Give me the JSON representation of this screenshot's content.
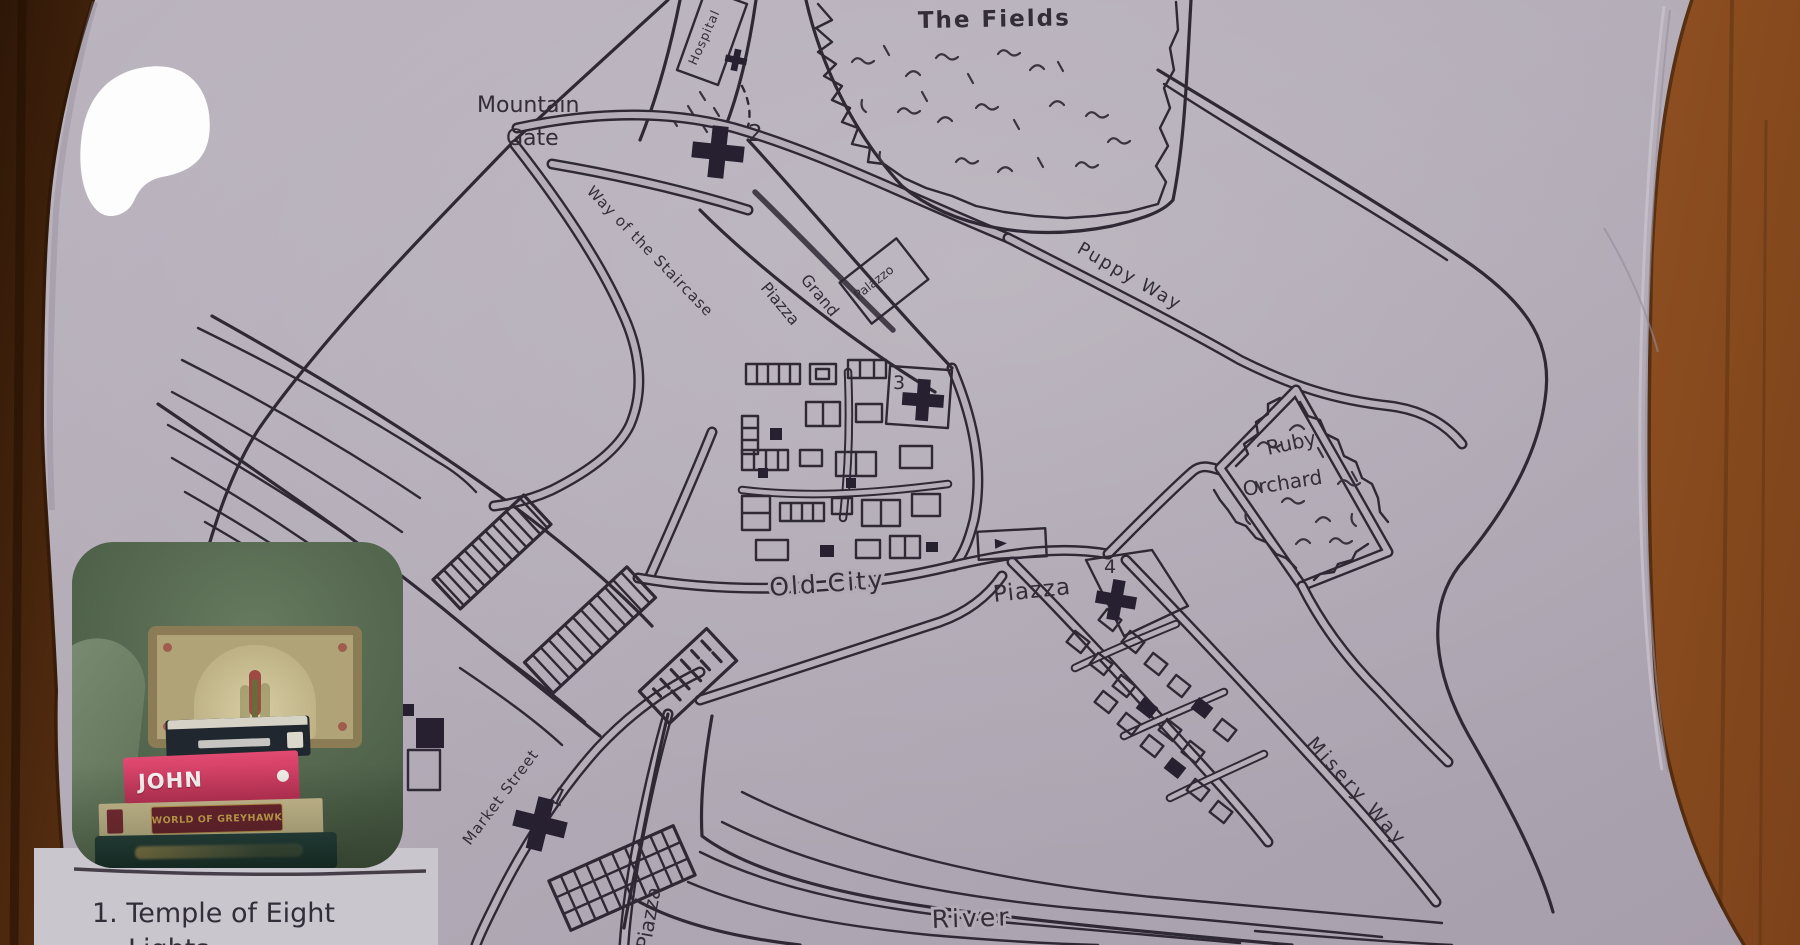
{
  "map": {
    "labels": {
      "the_fields": "The Fields",
      "mountain_gate_1": "Mountain",
      "mountain_gate_2": "Gate",
      "hospital": "Hospital",
      "way_of_the_staircase": "Way of the Staircase",
      "grand": "Grand",
      "grand_piazza": "Piazza",
      "palazzo": "Palazzo",
      "puppy_way": "Puppy Way",
      "ruby": "Ruby",
      "orchard": "Orchard",
      "old_city": "Old City",
      "piazza": "Piazza",
      "market_street": "Market Street",
      "misery_way": "Misery Way",
      "river": "River",
      "south_piazza": "Piazza"
    },
    "markers": {
      "temple_1": "1",
      "temple_2": "2",
      "temple_3": "3",
      "temple_4": "4"
    }
  },
  "legend": {
    "line_1": "1. Temple of Eight",
    "line_2": "Lights"
  },
  "webcam": {
    "books": {
      "pink_spine": "JOHN CARTER",
      "boxed_set": "WORLD OF GREYHAWK"
    }
  }
}
